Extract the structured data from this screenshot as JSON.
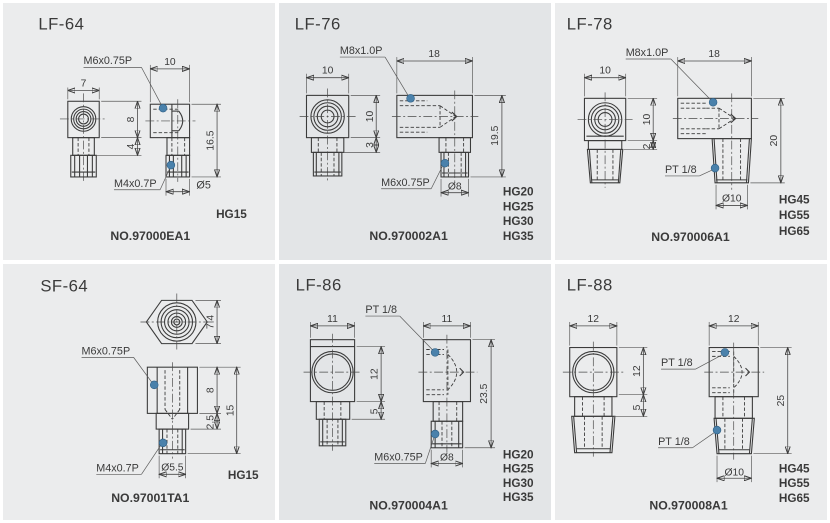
{
  "colors": {
    "panel_bg_outer": "#ebeced",
    "panel_bg_middle": "#e3e5e7",
    "line": "#3b3b3b",
    "text": "#3a3a3a",
    "marker_dot": "#4a81ab",
    "gutter": "#ffffff"
  },
  "panels": [
    {
      "title": "LF-64",
      "part_no": "NO.97000EA1",
      "top_thread": "M6x0.75P",
      "bottom_thread": "M4x0.7P",
      "dims": {
        "front_width": "7",
        "side_width": "10",
        "body_h": "8",
        "neck_h": "4",
        "total_h": "16.5",
        "stub_dia": "Ø5"
      },
      "rails": [
        "HG15"
      ]
    },
    {
      "title": "LF-76",
      "part_no": "NO.970002A1",
      "top_thread": "M8x1.0P",
      "bottom_thread": "M6x0.75P",
      "dims": {
        "front_width": "10",
        "side_width": "18",
        "body_h": "10",
        "neck_h": "3",
        "total_h": "19.5",
        "stub_dia": "Ø8"
      },
      "rails": [
        "HG20",
        "HG25",
        "HG30",
        "HG35"
      ]
    },
    {
      "title": "LF-78",
      "part_no": "NO.970006A1",
      "top_thread": "M8x1.0P",
      "bottom_thread": "PT 1/8",
      "dims": {
        "front_width": "10",
        "side_width": "18",
        "body_h": "10",
        "neck_h": "2",
        "total_h": "20",
        "stub_dia": "Ø10"
      },
      "rails": [
        "HG45",
        "HG55",
        "HG65"
      ]
    },
    {
      "title": "SF-64",
      "part_no": "NO.97001TA1",
      "top_thread": "M6x0.75P",
      "bottom_thread": "M4x0.7P",
      "dims": {
        "hex_width": "7.4",
        "body_h": "8",
        "neck_h": "2.5",
        "total_h": "15",
        "stub_dia": "Ø5.5"
      },
      "rails": [
        "HG15"
      ]
    },
    {
      "title": "LF-86",
      "part_no": "NO.970004A1",
      "top_thread": "PT 1/8",
      "bottom_thread": "M6x0.75P",
      "dims": {
        "front_width": "11",
        "side_width": "11",
        "body_h": "12",
        "neck_h": "5",
        "total_h": "23.5",
        "stub_dia": "Ø8"
      },
      "rails": [
        "HG20",
        "HG25",
        "HG30",
        "HG35"
      ]
    },
    {
      "title": "LF-88",
      "part_no": "NO.970008A1",
      "top_thread": "PT 1/8",
      "bottom_thread": "PT 1/8",
      "dims": {
        "front_width": "12",
        "side_width": "12",
        "body_h": "12",
        "neck_h": "5",
        "total_h": "25",
        "stub_dia": "Ø10"
      },
      "rails": [
        "HG45",
        "HG55",
        "HG65"
      ]
    }
  ]
}
